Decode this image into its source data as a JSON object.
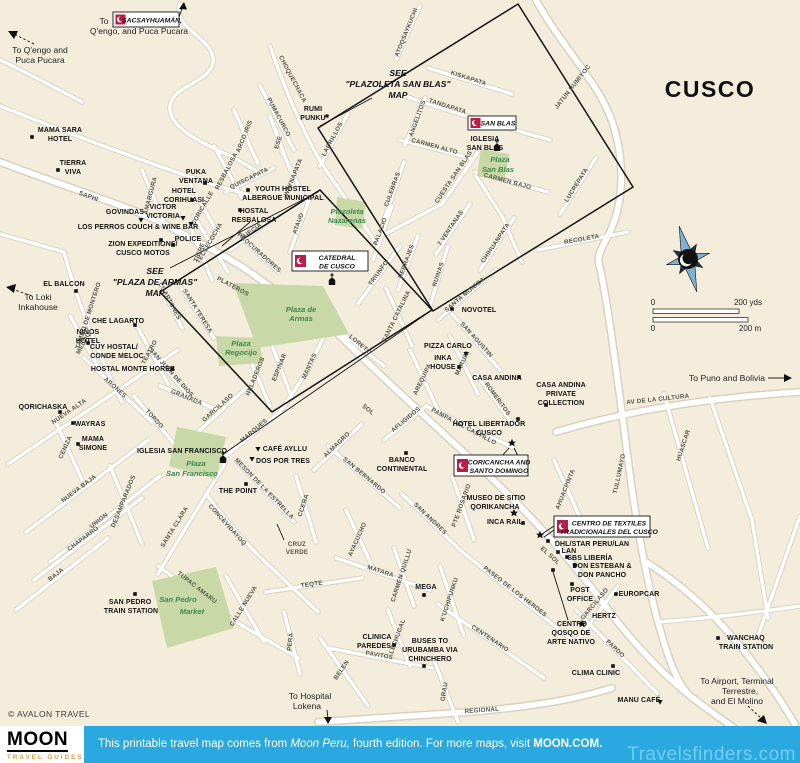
{
  "title": "CUSCO",
  "copyright": "© AVALON TRAVEL",
  "colors": {
    "map_bg": "#f4eddc",
    "road": "#ffffff",
    "road_casing": "#d9d2c0",
    "park_green": "#c8d8a6",
    "park_label_green": "#3a8a50",
    "badge_red": "#b81e47",
    "banner_blue": "#2aa9e0",
    "brand_orange": "#d89a3e"
  },
  "scale": {
    "zero_top": "0",
    "yds": "200 yds",
    "zero_bottom": "0",
    "m": "200 m"
  },
  "footer": {
    "brand": "MOON",
    "brand_sub": "TRAVEL GUIDES",
    "banner_pre": "This printable travel map comes from ",
    "banner_book": "Moon Peru,",
    "banner_mid": " fourth edition. For more maps, visit ",
    "banner_site": "MOON.COM.",
    "watermark": "Travelsfinders.com"
  },
  "badges": {
    "sacsayhuaman": "SACSAYHUAMÁN,",
    "san_blas": "SAN BLAS",
    "catedral_1": "CATEDRAL",
    "catedral_2": "DE CUSCO",
    "coricancha_1": "CORICANCHA AND",
    "coricancha_2": "SANTO DOMINGO",
    "textiles_1": "CENTRO DE TEXTILES",
    "textiles_2": "TRADICIONALES DEL CUSCO"
  },
  "see_notes": {
    "san_blas_1": "SEE",
    "san_blas_2": "\"PLAZOLETA SAN BLAS\"",
    "san_blas_3": "MAP",
    "armas_1": "SEE",
    "armas_2": "\"PLAZA DE ARMAS\"",
    "armas_3": "MAP"
  },
  "to_labels": [
    "To",
    "Q'engo, and Puca Pucara",
    "To Q'engo and",
    "Puca Pucara",
    "To Loki",
    "Inkahouse",
    "To Puno and Bolivia",
    "To Hospital",
    "Lokena",
    "To Airport, Terminal",
    "Terrestre,",
    "and El Molino"
  ],
  "plazas": [
    "Plazoleta",
    "Nazarenas",
    "Plaza de",
    "Armas",
    "Plaza",
    "Regocijo",
    "Plaza",
    "San Blas",
    "Plaza",
    "San Francisco",
    "San Pedro",
    "Market"
  ],
  "pois": [
    "MAMA SARA",
    "HOTEL",
    "TIERRA",
    "VIVA",
    "PUKA",
    "VENTANA",
    "HOTEL",
    "CORIHUASI",
    "YOUTH HOSTEL",
    "ALBERGUE MUNICIPAL",
    "HOSTAL",
    "RESBALOSA",
    "VICTOR",
    "VICTORIA",
    "GOVINDAS",
    "LOS PERROS COUCH & WINE BAR",
    "ZION EXPEDITIONS/",
    "CUSCO MOTOS",
    "POLICE",
    "EL BALCON",
    "RUMI",
    "PUNKU",
    "IGLESIA",
    "SAN BLAS",
    "CHE LAGARTO",
    "NIÑOS",
    "HOTEL",
    "CUY HOSTAL/",
    "CONDE MELOC",
    "HOSTAL MONTE HOREB",
    "NOVOTEL",
    "PIZZA CARLO",
    "INKA",
    "HOUSE",
    "CASA ANDINA",
    "CASA ANDINA",
    "PRIVATE",
    "COLLECTION",
    "HOTEL LIBERTADOR",
    "CUSCO",
    "QORICHASKA",
    "WAYRAS",
    "MAMA",
    "SIMONE",
    "IGLESIA SAN FRANCISCO",
    "CAFÉ AYLLU",
    "DOS POR TRES",
    "THE POINT",
    "BANCO",
    "CONTINENTAL",
    "MUSEO DE SITIO",
    "QORIKANCHA",
    "INCA RAIL",
    "DHL/STAR PERU/LAN",
    "LAN",
    "SBS LIBERÍA",
    "DON ESTEBAN &",
    "DON PANCHO",
    "POST",
    "OFFICE",
    "EUROPCAR",
    "HERTZ",
    "CENTRO",
    "QOSQO DE",
    "ARTE NATIVO",
    "CLIMA CLINIC",
    "MANU CAFÉ",
    "WANCHAQ",
    "TRAIN STATION",
    "SAN PEDRO",
    "TRAIN STATION",
    "MEGA",
    "CLINICA",
    "PAREDES",
    "BUSES TO",
    "URUBAMBA VIA",
    "CHINCHERO"
  ],
  "streets": [
    "SAPHI",
    "AMARGURA",
    "RESBALOSA",
    "CORICALLE",
    "TECSECOCHA",
    "QUISCAPATA",
    "WAYNAPATA",
    "LADRILLOS",
    "CHOQUECHACA",
    "PUMACURCO",
    "ARCO IRIS",
    "ESE",
    "ATOQSAYKUCHI",
    "KISKAPATA",
    "TANDAPATA",
    "ANGELITOS",
    "CARMEN ALTO",
    "CUESTA SAN BLAS",
    "CARMEN BAJO",
    "JATUN RUMIYOC",
    "LUCREPATA",
    "RECOLETA",
    "7 VENTANAS",
    "CHIHUANPATA",
    "SUECIA",
    "PROCURADORES",
    "TIGRE",
    "PLATEROS",
    "CUARTONES",
    "SANTA TERESA",
    "TAMBO DE MONTERO",
    "TEATRO",
    "MELOQ",
    "ARONES",
    "NUEVA ALTA",
    "CENIZA",
    "NUEVA BAJA",
    "UNION",
    "CHAPARRO",
    "BAJA",
    "DESAMPARADOS",
    "TORDO",
    "SAN JUAN DE DIOS",
    "GRANADA",
    "GARCILASO",
    "MARQUES",
    "MESON DE LA ESTRELLA",
    "SANTA CLARA",
    "CONCEVIDAYOQ",
    "CCERA",
    "TEQTE",
    "PERA",
    "CALLE NUEVA",
    "TUPAC AMARU",
    "MATARA",
    "CARMEN QUILLU",
    "LECHUGAL",
    "K'UCHIPUNKU",
    "PAVITOS",
    "BELEN",
    "GRAU",
    "CENTENARIO",
    "REGIONAL",
    "AYACUCHO",
    "SAN BERNARDO",
    "ALMAGRO",
    "SOL",
    "EL SOL",
    "AFLIGIDOS",
    "PAMPA DEL CASTILLO",
    "ROMERITOS",
    "SAN ANDRES",
    "PTE ROSARIO",
    "PASEO DE LOS HEROES",
    "MARURI",
    "AREQUIPA",
    "SANTA CATALINA",
    "SAN AGUSTIN",
    "SANTA MONICA",
    "RUINAS",
    "HERRAJES",
    "PALACIO",
    "TRIUNFO",
    "ATAUD",
    "CULEBRAS",
    "LORETO",
    "MANTAS",
    "ESPINAR",
    "HELADEROS",
    "HUASCAR",
    "TULLUMAYO",
    "AHUACPINTA",
    "AV DE LA CULTURA",
    "PARDO",
    "GARCILASO",
    "CRUZ",
    "VERDE"
  ]
}
